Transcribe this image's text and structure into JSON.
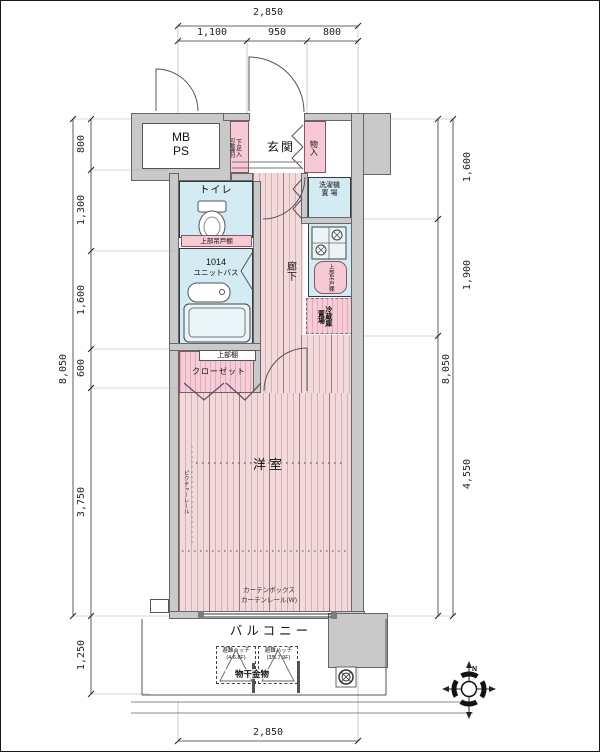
{
  "dims": {
    "top": {
      "total": "2,850",
      "segments": [
        "1,100",
        "950",
        "800"
      ]
    },
    "left": {
      "segments": [
        "800",
        "1,300",
        "1,600",
        "600",
        "3,750"
      ],
      "total": "8,050",
      "balcony": "1,250"
    },
    "right": {
      "segments": [
        "1,600",
        "1,900"
      ],
      "lower": "4,550",
      "total": "8,050"
    },
    "bottom": {
      "total": "2,850"
    }
  },
  "labels": {
    "mb": "MB",
    "ps": "PS",
    "genkan": "玄関",
    "shoes": "下足入",
    "shoes_note": "可動棚付",
    "monoire": "物入",
    "toilet": "トイレ",
    "toilet_shelf": "上部吊戸棚",
    "washer_1": "洗濯機",
    "washer_2": "置 場",
    "bath_1": "1014",
    "bath_2": "ユニットバス",
    "corridor": "廊下",
    "kitchen_shelf": "上部吊戸棚",
    "fridge_1": "冷蔵庫",
    "fridge_2": "置場",
    "closet_shelf": "上部棚",
    "closet": "クローゼット",
    "room": "洋室",
    "picture_rail": "ピクチャーレール",
    "curtain_box": "カーテンボックス",
    "curtain_rail": "カーテンレール(W)",
    "balcony": "バルコニー",
    "hatch": "避難ハッチ",
    "hatch_floors_1": "(4.6.8F)",
    "hatch_floors_2": "(3/5.7.9F)",
    "laundry": "物干金物",
    "north": "N"
  },
  "colors": {
    "wall": "#c9c9c9",
    "floor": "#f2dada",
    "floor_stripe": "#8c4646",
    "water_room": "#d3ecf3",
    "storage_pink": "#f6c9d4",
    "outline": "#444444"
  }
}
